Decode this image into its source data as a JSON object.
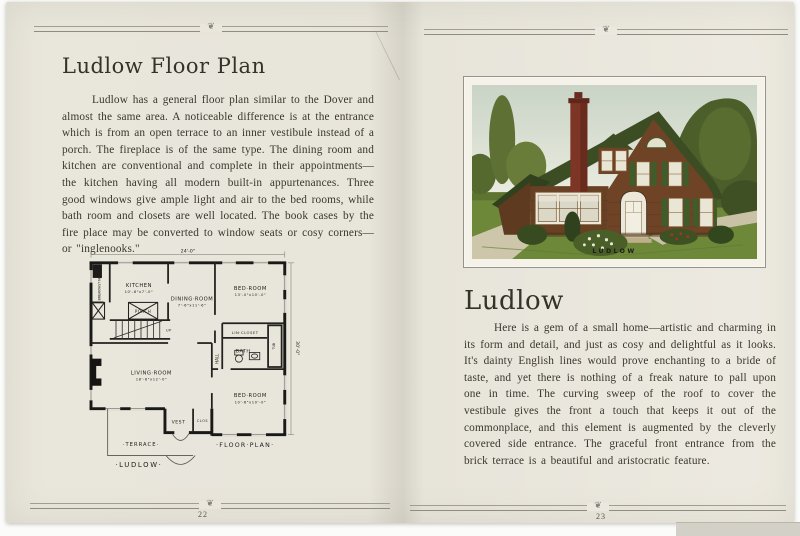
{
  "decor": {
    "ornament": "❦"
  },
  "left_page": {
    "page_number": "22",
    "title": "Ludlow Floor Plan",
    "body": "Ludlow has a general floor plan similar to the Dover and almost the same area.  A noticeable difference is at the entrance which is from an open terrace to an inner vestibule instead of a porch.  The fireplace is of the same type.  The dining room and kitchen are conventional and complete in their appointments—the kitchen having all modern built-in appurtenances.  Three good windows give ample light and air to the bed rooms, while bath room and closets are well located.  The book cases by the fire place may be converted to window seats or cosy corners—or \"inglenooks.\"",
    "plan": {
      "dim_width": "24'-0\"",
      "dim_depth": "30'-0\"",
      "kitchen": "KITCHEN",
      "kitchen_dims": "10'-6\"x7'-0\"",
      "dining": "DINING·ROOM",
      "dining_dims": "7'-6\"x11'-6\"",
      "bed1": "BED·ROOM",
      "bed1_dims": "13'-0\"x10'-0\"",
      "bed2": "BED·ROOM",
      "bed2_dims": "10'-6\"x10'-0\"",
      "living": "LIVING·ROOM",
      "living_dims": "18'-6\"x12'-0\"",
      "bath": "BATH",
      "closet": "LIN·CLOSET",
      "hall": "HALL",
      "tub": "TUB",
      "nook": "BREAKFAST·NOOK",
      "porch": "PORCH",
      "up": "UP",
      "vest": "VEST",
      "clos": "CLOS",
      "terrace": "·TERRACE·",
      "plan_caption": "·FLOOR·PLAN·",
      "plan_name": "·LUDLOW·"
    }
  },
  "right_page": {
    "page_number": "23",
    "title": "Ludlow",
    "body": "Here is a gem of a small home—artistic and charming in its form and detail, and just as cosy and delightful as it looks.  It's dainty English lines would prove enchanting to a bride of taste, and yet there is nothing of a freak nature to pall upon one in time.  The curving sweep of the roof to cover the vestibule gives the front a touch that keeps it out of the commonplace, and this element is augmented by the cleverly covered side entrance.  The graceful front entrance from the brick terrace is a beautiful and aristocratic feature.",
    "illustration_caption": "LUDLOW"
  }
}
